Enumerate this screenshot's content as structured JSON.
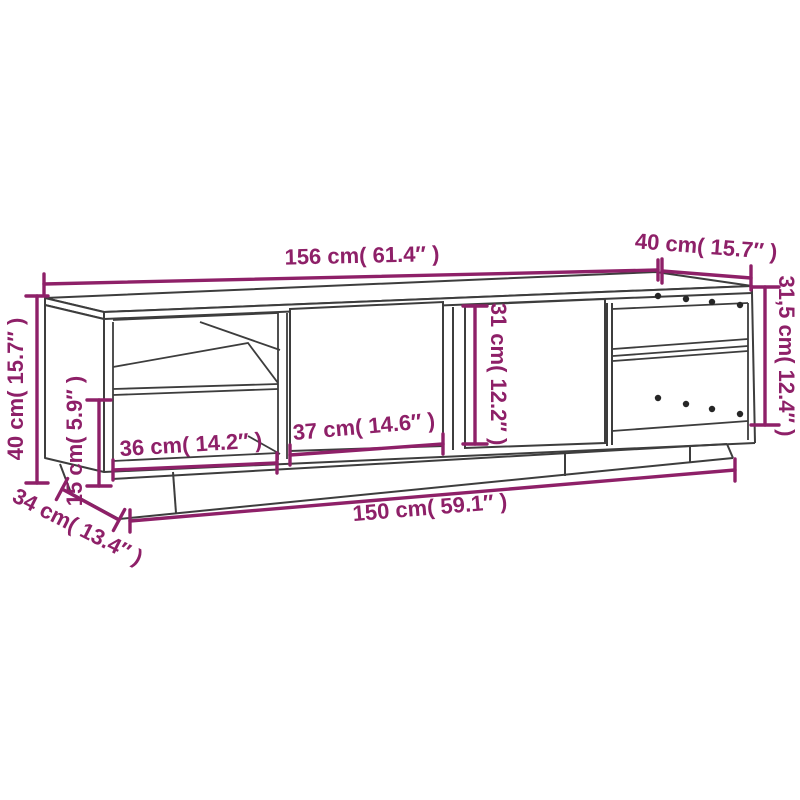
{
  "diagram": {
    "kind": "furniture dimension drawing",
    "subject": "TV cabinet with two doors, open shelves and plinth base",
    "colors": {
      "dimension_accent": "#8E2068",
      "drawing_outline": "#3D3D3D",
      "background": "#FFFFFF",
      "hole_dots": "#262626"
    },
    "dims": {
      "width_top": {
        "label": "156 cm( 61.4″ )"
      },
      "depth_top": {
        "label": "40 cm( 15.7″ )"
      },
      "height_right": {
        "label": "31,5 cm( 12.4″ )"
      },
      "height_left": {
        "label": "40 cm( 15.7″ )"
      },
      "plinth_height": {
        "label": "15 cm( 5.9″ )"
      },
      "shelf_width": {
        "label": "36 cm( 14.2″ )"
      },
      "door_width": {
        "label": "37 cm( 14.6″ )"
      },
      "door_height": {
        "label": "31 cm( 12.2″ )"
      },
      "width_bottom": {
        "label": "150 cm( 59.1″ )"
      },
      "depth_bottom": {
        "label": "34 cm( 13.4″ )"
      }
    }
  }
}
